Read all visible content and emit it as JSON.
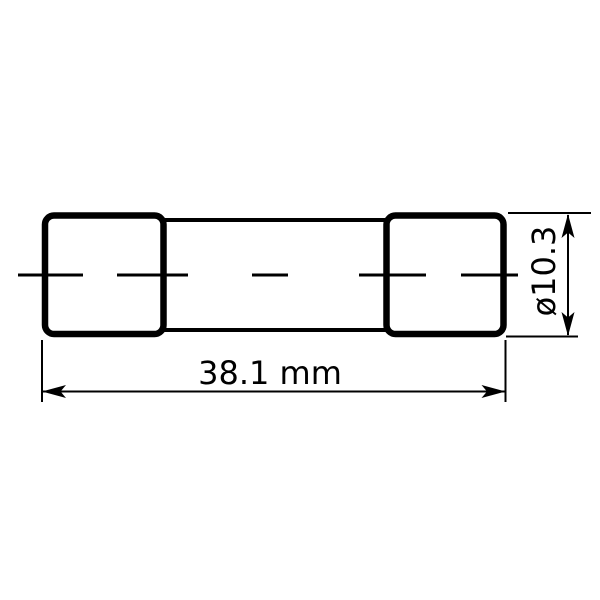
{
  "drawing": {
    "type": "technical-dimension-drawing",
    "subject": "cartridge fuse, side view",
    "colors": {
      "line": "#000000",
      "fill": "#ffffff",
      "background": "#ffffff"
    },
    "dimensions": {
      "length": {
        "label": "38.1 mm"
      },
      "diameter": {
        "label": "ø10.3"
      }
    }
  }
}
